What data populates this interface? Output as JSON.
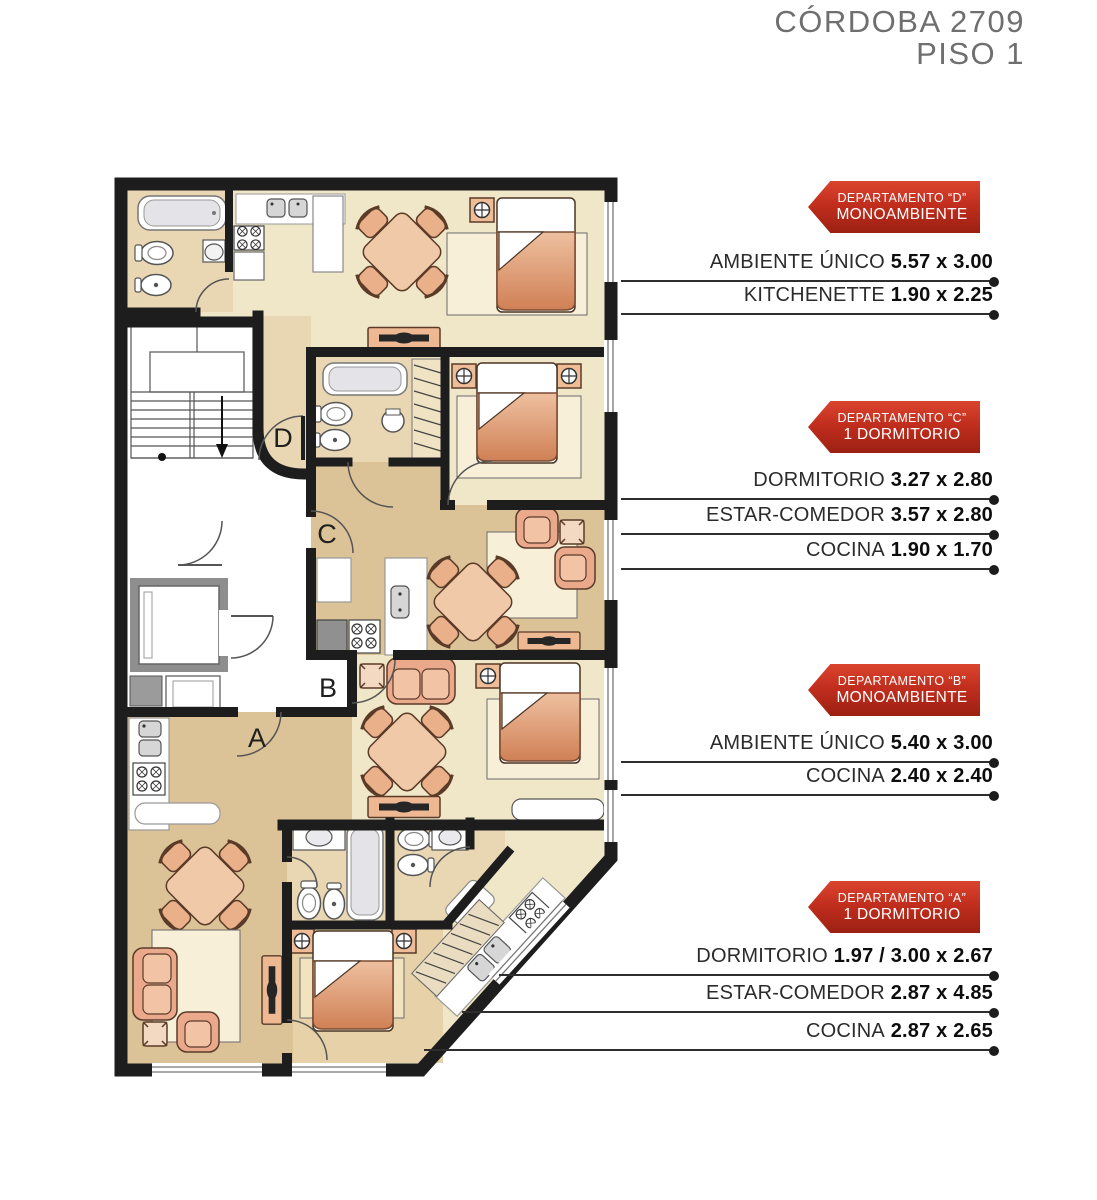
{
  "title": {
    "line1": "CÓRDOBA 2709",
    "line2": "PISO 1"
  },
  "plan": {
    "unit_labels": {
      "d": "D",
      "c": "C",
      "b": "B",
      "a": "A"
    }
  },
  "apartments": [
    {
      "id": "D",
      "badge": {
        "line1": "DEPARTAMENTO “D”",
        "line2": "MONOAMBIENTE"
      },
      "rooms": [
        {
          "label": "AMBIENTE ÚNICO",
          "dims": "5.57 x 3.00"
        },
        {
          "label": "KITCHENETTE",
          "dims": "1.90 x 2.25"
        }
      ]
    },
    {
      "id": "C",
      "badge": {
        "line1": "DEPARTAMENTO “C”",
        "line2": "1 DORMITORIO"
      },
      "rooms": [
        {
          "label": "DORMITORIO",
          "dims": "3.27 x 2.80"
        },
        {
          "label": "ESTAR-COMEDOR",
          "dims": "3.57 x 2.80"
        },
        {
          "label": "COCINA",
          "dims": "1.90 x 1.70"
        }
      ]
    },
    {
      "id": "B",
      "badge": {
        "line1": "DEPARTAMENTO “B”",
        "line2": "MONOAMBIENTE"
      },
      "rooms": [
        {
          "label": "AMBIENTE ÚNICO",
          "dims": "5.40 x 3.00"
        },
        {
          "label": "COCINA",
          "dims": "2.40 x 2.40"
        }
      ]
    },
    {
      "id": "A",
      "badge": {
        "line1": "DEPARTAMENTO “A”",
        "line2": "1 DORMITORIO"
      },
      "rooms": [
        {
          "label": "DORMITORIO",
          "dims": "1.97 / 3.00 x 2.67"
        },
        {
          "label": "ESTAR-COMEDOR",
          "dims": "2.87 x 4.85"
        },
        {
          "label": "COCINA",
          "dims": "2.87 x 2.65"
        }
      ]
    }
  ],
  "colors": {
    "badge_red": "#c22e1e",
    "wall": "#1d1d1d",
    "title_gray": "#6f6f6f",
    "floor_cream": "#f0e6c8",
    "floor_tan": "#dcc297",
    "floor_beige": "#e9d7b4",
    "furniture_salmon": "#eba98c",
    "bed_blanket": "#d98f66"
  }
}
